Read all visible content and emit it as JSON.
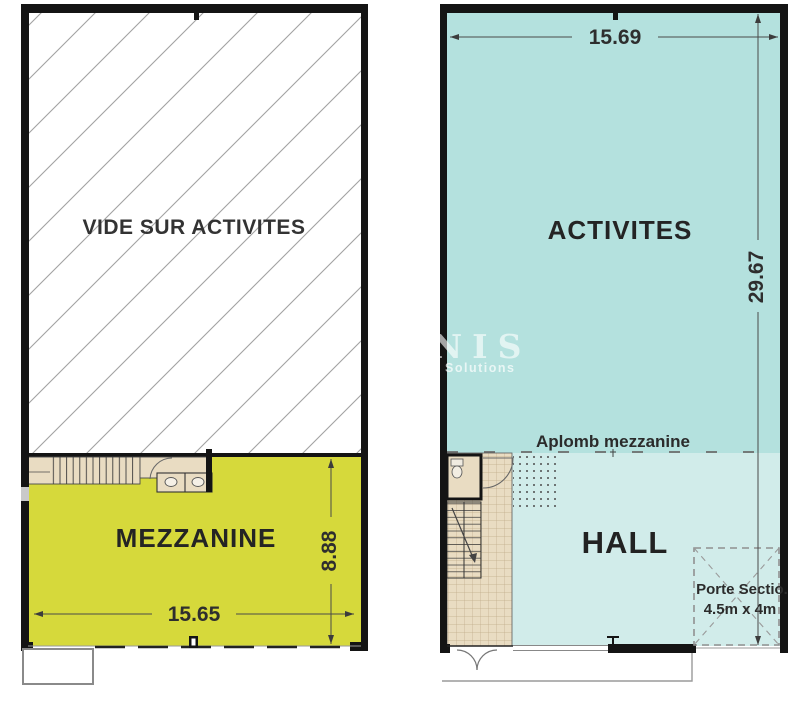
{
  "colors": {
    "wall": "#141414",
    "mezzanine_fill": "#d6d93b",
    "activites_fill": "#b4e1de",
    "hall_fill": "#d1ecea",
    "tile_fill": "#e9dcc2",
    "dim_line": "#4a4a4a"
  },
  "left_plan": {
    "void_label": "VIDE SUR ACTIVITES",
    "room_label": "MEZZANINE",
    "width_label": "15.65",
    "height_label": "8.88"
  },
  "right_plan": {
    "room_label": "ACTIVITES",
    "hall_label": "HALL",
    "aplomb_label": "Aplomb mezzanine",
    "width_label": "15.69",
    "height_label": "29.67",
    "door_label": "Porte Sectio.",
    "door_size_label": "4.5m x 4m"
  },
  "watermark": {
    "text": "NIS",
    "subtext": "Solutions"
  }
}
